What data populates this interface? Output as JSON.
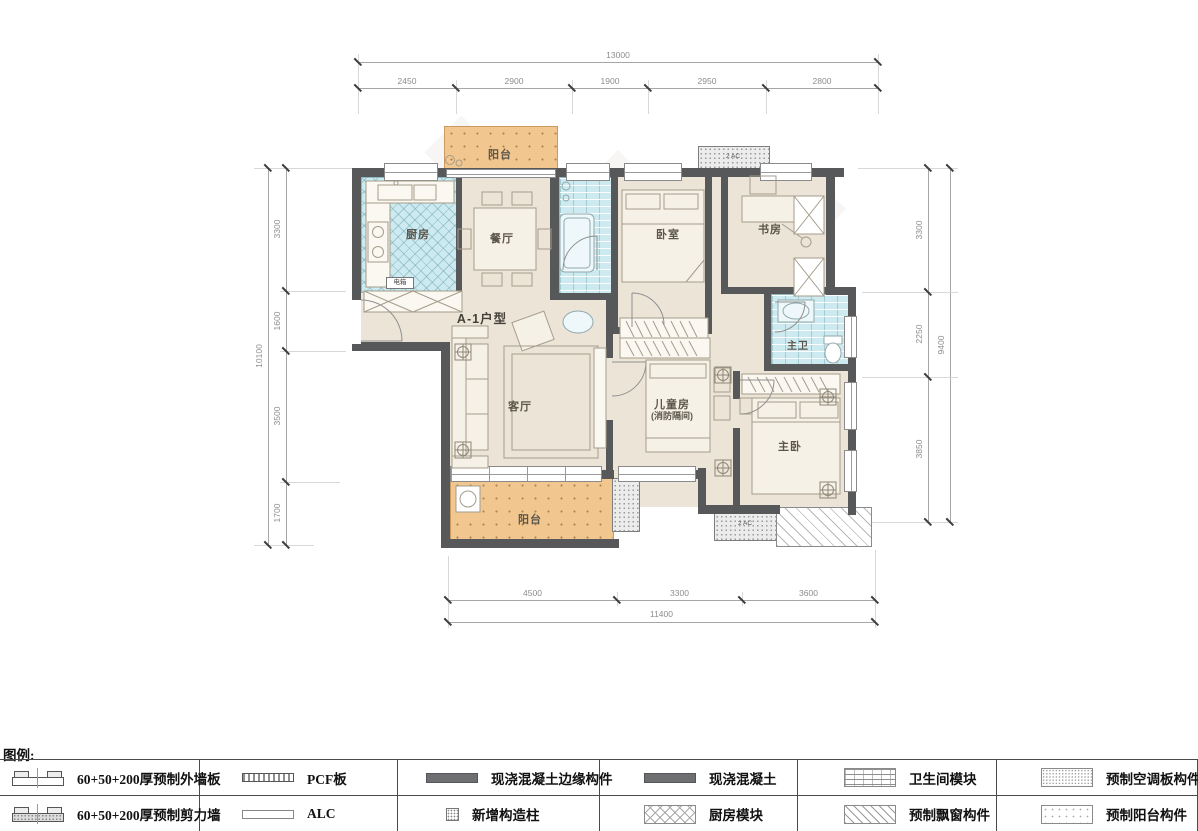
{
  "plan": {
    "unit_label": "A-1户型",
    "rooms": {
      "balcony_top": "阳台",
      "kitchen": "厨房",
      "dining": "餐厅",
      "bedroom": "卧室",
      "study": "书房",
      "master_bath": "主卫",
      "living": "客厅",
      "children_line1": "儿童房",
      "children_line2": "(消防隔间)",
      "master_bedroom": "主卧",
      "balcony_bottom": "阳台",
      "electrical_box": "电箱",
      "ac_top": "2 AC",
      "ac_bottom": "2 AC"
    }
  },
  "dimensions": {
    "top": {
      "total": "13000",
      "segments": [
        "2450",
        "2900",
        "1900",
        "2950",
        "2800"
      ]
    },
    "left": {
      "total": "10100",
      "segments": [
        "3300",
        "1600",
        "3500",
        "1700"
      ]
    },
    "right": {
      "total": "9400",
      "segments": [
        "3300",
        "2250",
        "3850"
      ]
    },
    "bottom": {
      "total": "11400",
      "segments": [
        "4500",
        "3300",
        "3600"
      ]
    }
  },
  "legend": {
    "title": "图例:",
    "row1": [
      {
        "symbol": "precast-exterior-wall-panel",
        "label": "60+50+200厚预制外墙板"
      },
      {
        "symbol": "pcf-panel",
        "label": "PCF板"
      },
      {
        "symbol": "cast-in-place-concrete-edge",
        "label": "现浇混凝土边缘构件"
      },
      {
        "symbol": "cast-in-place-concrete",
        "label": "现浇混凝土"
      },
      {
        "symbol": "bathroom-module",
        "label": "卫生间模块"
      },
      {
        "symbol": "precast-ac-slab",
        "label": "预制空调板构件"
      }
    ],
    "row2": [
      {
        "symbol": "precast-shear-wall",
        "label": "60+50+200厚预制剪力墙"
      },
      {
        "symbol": "alc-panel",
        "label": "ALC"
      },
      {
        "symbol": "new-structural-column",
        "label": "新增构造柱"
      },
      {
        "symbol": "kitchen-module",
        "label": "厨房模块"
      },
      {
        "symbol": "precast-bay-window",
        "label": "预制飘窗构件"
      },
      {
        "symbol": "precast-balcony",
        "label": "预制阳台构件"
      }
    ]
  },
  "colors": {
    "balcony": "#F2C68F",
    "module_cyan": "#CDEAF0",
    "wall": "#57585A",
    "floor": "#EBE4D7"
  }
}
